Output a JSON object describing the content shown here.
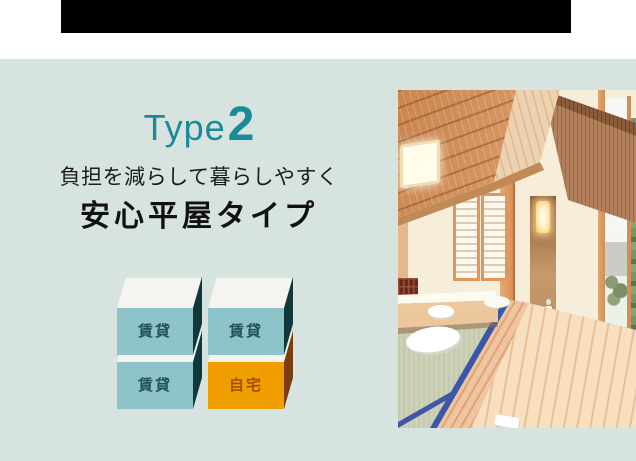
{
  "header": {
    "bar_color": "#000000"
  },
  "section": {
    "background_color": "#d7e3df",
    "accent_color": "#1b8b9b",
    "type_badge": {
      "word": "Type",
      "number": "2"
    },
    "subtitle": "負担を減らして暮らしやすく",
    "title": "安心平屋タイプ",
    "diagram": {
      "boxes": [
        {
          "label": "賃貸",
          "variant": "rental"
        },
        {
          "label": "賃貸",
          "variant": "rental"
        },
        {
          "label": "賃貸",
          "variant": "rental"
        },
        {
          "label": "自宅",
          "variant": "home"
        }
      ],
      "colors": {
        "rental_front": "#8cc4ca",
        "rental_side": "#11393c",
        "top_face": "#f5f4f1",
        "rental_text": "#235358",
        "home_front": "#f09e00",
        "home_side": "#7b3d0d",
        "home_text": "#a04e00"
      }
    }
  }
}
